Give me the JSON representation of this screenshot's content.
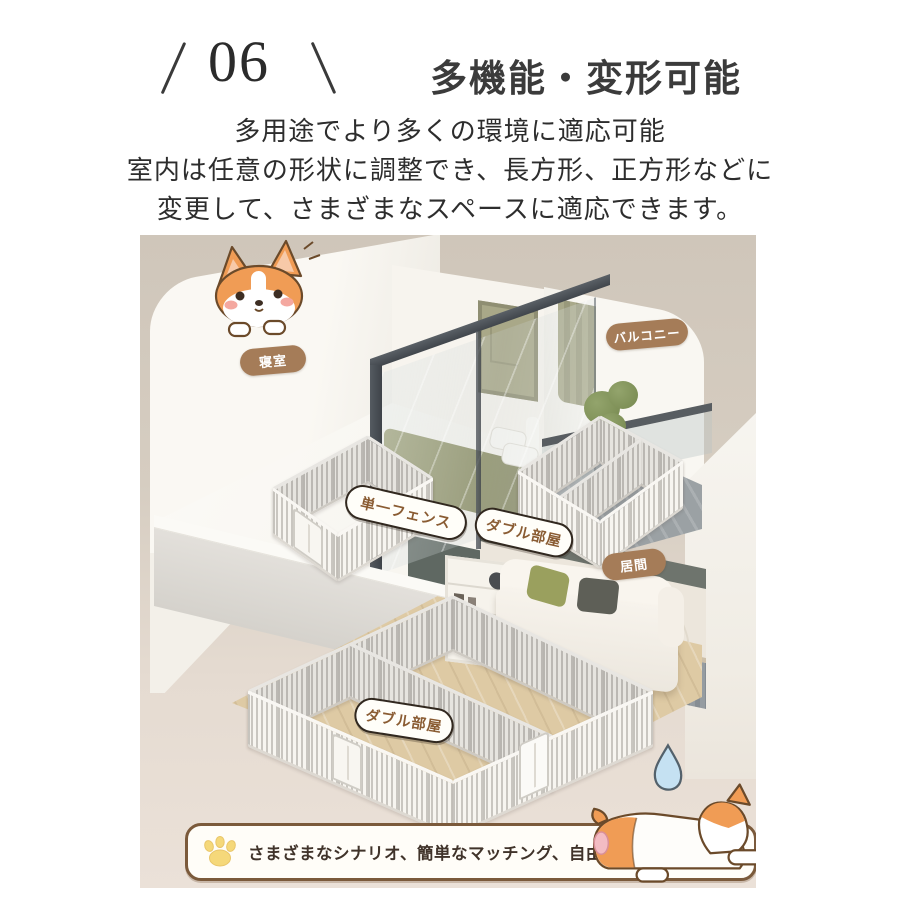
{
  "header": {
    "number": "06",
    "title": "多機能・変形可能"
  },
  "description": {
    "line1": "多用途でより多くの環境に適応可能",
    "line2": "室内は任意の形状に調整でき、長方形、正方形などに",
    "line3": "変更して、さまざまなスペースに適応できます。"
  },
  "illustration": {
    "badges": {
      "bedroom": "寝室",
      "balcony": "バルコニー",
      "single_fence": "単一フェンス",
      "double_room_upper": "ダブル部屋",
      "living_room": "居間",
      "double_room_lower": "ダブル部屋"
    },
    "icons": {
      "corgi_peeking": "corgi-peeking-icon",
      "corgi_sleeping": "corgi-sleeping-icon",
      "sleep_drop": "sleep-drop-icon"
    }
  },
  "banner": {
    "paw_icon": "paw-icon",
    "text": "さまざまなシナリオ、簡単なマッチング、自由な拡張"
  },
  "colors": {
    "bg-top": "#cfc6ba",
    "bg-bottom": "#ebe1d8",
    "badge-brown": "#a57c58",
    "badge-text-brown": "#8a5c33",
    "banner-border": "#7b5a3b",
    "paw-yellow": "#f5d87a",
    "corgi-orange": "#f09c55",
    "frame-dark": "#4a5056",
    "bed-green": "#94966c",
    "wood-floor": "#decaa4",
    "text-dark": "#2e2e2e"
  }
}
